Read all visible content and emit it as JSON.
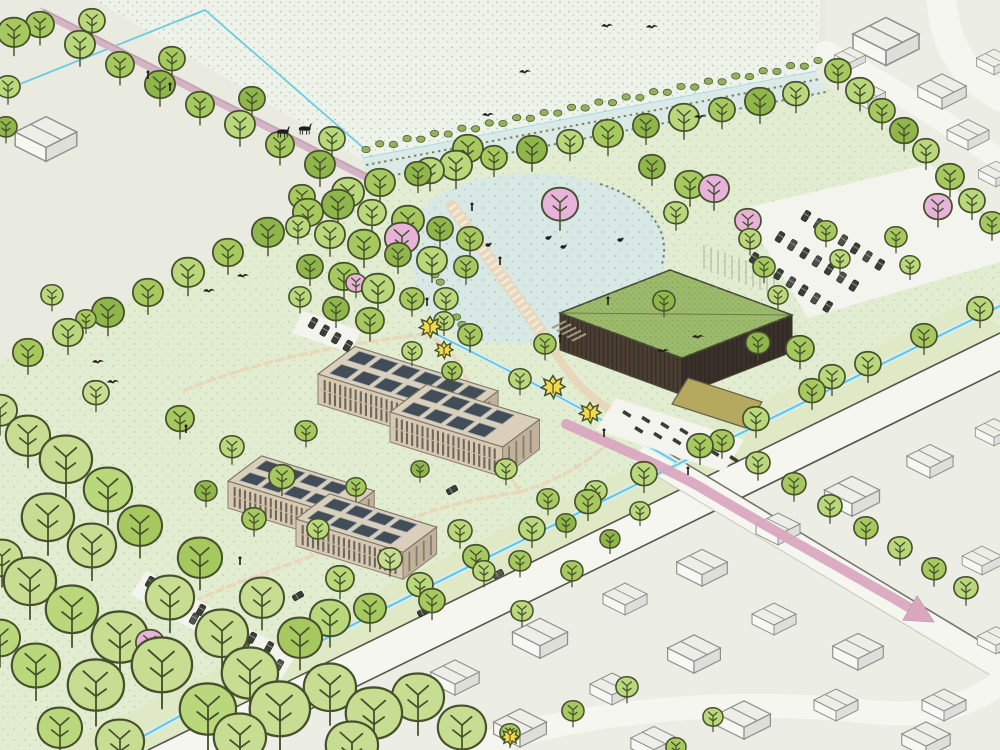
{
  "document": {
    "kind": "illustrated-aerial-masterplan",
    "description": "Hand-drawn isometric landscape masterplan: a new park with a pond, reed-lined canal, green-roof hall, two solar-panel apartment buildings, tree belts, meadows with deer and birds, parking areas, and an adjacent village of white sketched houses with a pink route arrow along the street."
  },
  "palette": {
    "base": "#e9ebe0",
    "villageGround": "#ecede5",
    "meadow": "#eef3ea",
    "meadowDot": "#b5c2b0",
    "parkGrass": "#e2ecd0",
    "parkDot": "#a3b98b",
    "verge": "#dfe9c6",
    "roadFill": "#f6f6f1",
    "roadEdge": "#55554b",
    "minorRoadEdge": "#c8c8c0",
    "lotFill": "#f4f4ee",
    "canal": "#dbeae6",
    "pond": "#d8e8e4",
    "pondSpeckle": "#a8c4bf",
    "waterLine": "#5ec7e3",
    "waterBand": "#d9edf0",
    "reed": "#5e6e48",
    "pathBeige": "#e8d7ba",
    "pathMauve": "#d4b4c4",
    "routePink": "#d9a8bf",
    "treeMid": "#a6c95f",
    "treeLight": "#b9d77b",
    "treeDark": "#8fb64a",
    "treePale": "#c7de92",
    "treeOlive": "#9cb75b",
    "treeOutline": "#47502c",
    "shrubOlive": "#93b05c",
    "blossomPink": "#e7b3da",
    "shrubYellow": "#f2d94b",
    "roofGreen": "#9cba6b",
    "roofSpeckle": "#7e9d4f",
    "roofEdge": "#474a36",
    "wallBrown": "#4a3e33",
    "wallBrownDark": "#39302a",
    "slatLine": "#28221d",
    "buildingTan": "#d5c9b4",
    "buildingShade": "#c0b29a",
    "roofTan": "#d9cfba",
    "windowDark": "#564e42",
    "solarPanel": "#424d57",
    "solarFrame": "#98a5ae",
    "canopyTan": "#b4a95f",
    "canopyEdge": "#6b6247",
    "houseFill": "#f7f7f3",
    "houseShade": "#dededa",
    "houseTop": "#eeeee9",
    "houseLine": "#8f8f89",
    "figure": "#1e1e1b",
    "trellisLine": "#a9af9b"
  },
  "features": [
    {
      "id": "meadow-field",
      "label": "dotted meadow with deer"
    },
    {
      "id": "reed-canal",
      "label": "reed-lined canal"
    },
    {
      "id": "pond",
      "label": "pond with boardwalk and steps"
    },
    {
      "id": "green-roof-building",
      "label": "hall with green sedum roof and timber slat walls"
    },
    {
      "id": "solar-buildings",
      "label": "apartment buildings with rooftop solar panels"
    },
    {
      "id": "parking-lot-east",
      "label": "tree-lined parking lot"
    },
    {
      "id": "parking-strip-southwest",
      "label": "parking strip in woodland"
    },
    {
      "id": "bicycle-yard",
      "label": "bicycle parking yard with canopy"
    },
    {
      "id": "village",
      "label": "village of white sketched houses"
    },
    {
      "id": "main-road",
      "label": "main road between park and village"
    },
    {
      "id": "route-arrow",
      "label": "pink route arrow through village street"
    },
    {
      "id": "tree-belts",
      "label": "tree rows and woodland clusters"
    },
    {
      "id": "blossom-trees",
      "label": "pink blossom trees"
    },
    {
      "id": "yellow-shrubs",
      "label": "yellow flowering shrubs"
    },
    {
      "id": "wildlife",
      "label": "birds, ducks and walkers"
    }
  ]
}
